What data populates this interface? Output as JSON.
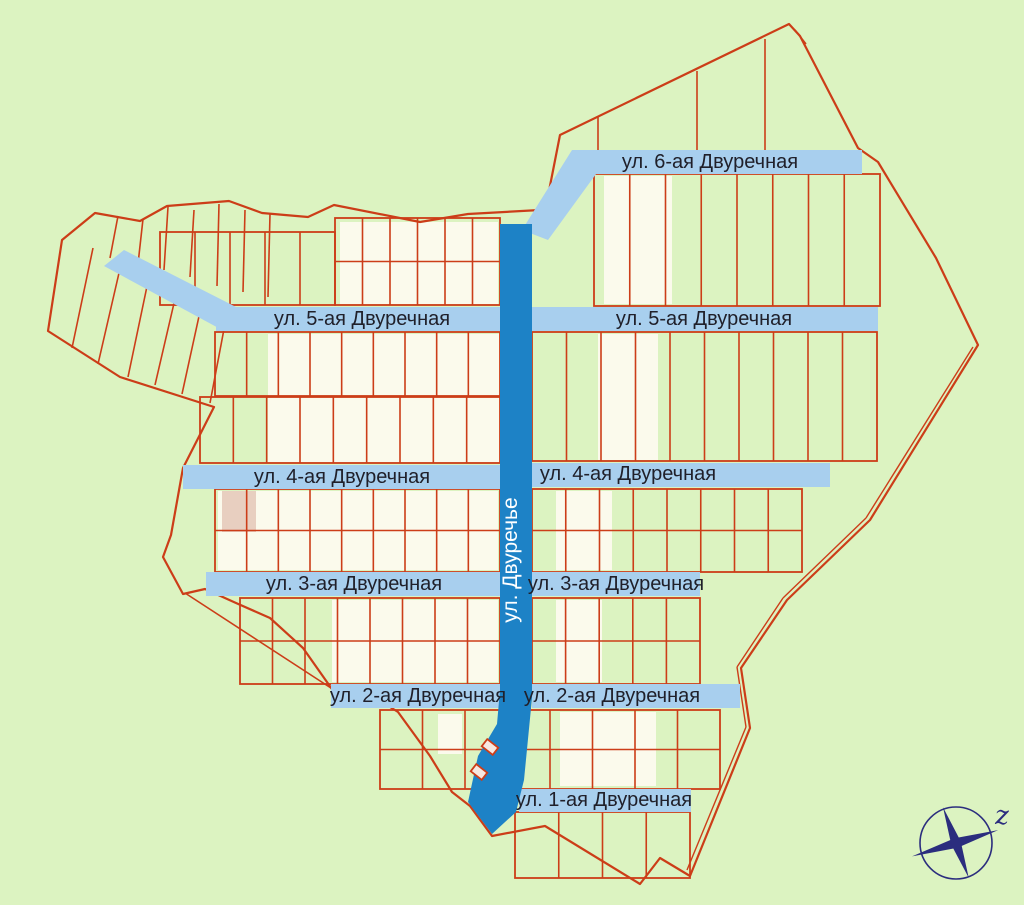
{
  "canvas": {
    "w": 1024,
    "h": 905
  },
  "colors": {
    "bg": "#dcf3c1",
    "parcel_white": "#fbfaec",
    "parcel_tan": "#e8cfc0",
    "line_red": "#cc3d18",
    "street_blue": "#a8cfee",
    "street_dark_blue": "#1d82c6",
    "label_text": "#20202a",
    "central_label_text": "#ffffff",
    "compass_navy": "#2b2d7e",
    "building_fill": "#f7e8e0"
  },
  "map": {
    "boundary": "95,213 140,221 167,206 229,201 262,213 308,217 334,205 420,222 468,214 540,210 548,196 560,135 789,24 800,36 858,148 878,162 936,258 978,345 870,520 787,600 741,668 750,728 690,876 660,858 640,884 545,826 492,836 470,806 452,792 430,756 398,712 357,686 334,692 303,648 270,618 236,603 205,589 183,594 163,557 171,535 183,468 214,407 120,377 48,331 62,240",
    "road_lines": [
      [
        973,
        347,
        866,
        518
      ],
      [
        866,
        518,
        783,
        598
      ],
      [
        783,
        598,
        737,
        667
      ],
      [
        737,
        667,
        746,
        727
      ],
      [
        746,
        727,
        687,
        870
      ]
    ],
    "extra_lines": [
      [
        93,
        248,
        72,
        348
      ],
      [
        122,
        260,
        98,
        364
      ],
      [
        150,
        272,
        128,
        377
      ],
      [
        178,
        286,
        155,
        385
      ],
      [
        203,
        298,
        182,
        394
      ],
      [
        228,
        308,
        210,
        403
      ],
      [
        118,
        216,
        110,
        258
      ],
      [
        143,
        219,
        138,
        264
      ],
      [
        168,
        207,
        164,
        270
      ],
      [
        194,
        210,
        190,
        277
      ],
      [
        219,
        204,
        217,
        286
      ],
      [
        245,
        210,
        243,
        292
      ],
      [
        270,
        214,
        268,
        297
      ],
      [
        598,
        117,
        598,
        150
      ],
      [
        697,
        71,
        697,
        151
      ],
      [
        765,
        39,
        765,
        152
      ],
      [
        795,
        30,
        806,
        44
      ],
      [
        185,
        593,
        334,
        690
      ]
    ],
    "patches": [
      {
        "x": 340,
        "y": 222,
        "w": 158,
        "h": 82,
        "fill": "white"
      },
      {
        "x": 268,
        "y": 334,
        "w": 232,
        "h": 128,
        "fill": "white"
      },
      {
        "x": 598,
        "y": 334,
        "w": 60,
        "h": 126,
        "fill": "white"
      },
      {
        "x": 218,
        "y": 491,
        "w": 280,
        "h": 79,
        "fill": "white"
      },
      {
        "x": 556,
        "y": 491,
        "w": 56,
        "h": 79,
        "fill": "white"
      },
      {
        "x": 332,
        "y": 600,
        "w": 166,
        "h": 82,
        "fill": "white"
      },
      {
        "x": 556,
        "y": 600,
        "w": 46,
        "h": 82,
        "fill": "white"
      },
      {
        "x": 604,
        "y": 176,
        "w": 68,
        "h": 128,
        "fill": "white"
      },
      {
        "x": 560,
        "y": 712,
        "w": 96,
        "h": 74,
        "fill": "white"
      },
      {
        "x": 420,
        "y": 242,
        "w": 78,
        "h": 62,
        "fill": "white"
      },
      {
        "x": 438,
        "y": 714,
        "w": 24,
        "h": 40,
        "fill": "white"
      },
      {
        "x": 222,
        "y": 491,
        "w": 34,
        "h": 41,
        "fill": "tan"
      }
    ],
    "blocks": [
      {
        "x": 335,
        "y": 218,
        "w": 165,
        "h": 87,
        "cols": 6,
        "rows": 2
      },
      {
        "x": 160,
        "y": 232,
        "w": 175,
        "h": 73,
        "cols": 5,
        "rows": 1
      },
      {
        "x": 215,
        "y": 332,
        "w": 285,
        "h": 64,
        "cols": 9,
        "rows": 1
      },
      {
        "x": 200,
        "y": 397,
        "w": 300,
        "h": 66,
        "cols": 9,
        "rows": 1
      },
      {
        "x": 532,
        "y": 332,
        "w": 345,
        "h": 129,
        "cols": 10,
        "rows": 1
      },
      {
        "x": 215,
        "y": 489,
        "w": 285,
        "h": 83,
        "cols": 9,
        "rows": 2
      },
      {
        "x": 532,
        "y": 489,
        "w": 270,
        "h": 83,
        "cols": 8,
        "rows": 2
      },
      {
        "x": 240,
        "y": 598,
        "w": 260,
        "h": 86,
        "cols": 8,
        "rows": 2
      },
      {
        "x": 532,
        "y": 598,
        "w": 168,
        "h": 86,
        "cols": 5,
        "rows": 2
      },
      {
        "x": 380,
        "y": 710,
        "w": 340,
        "h": 79,
        "cols": 8,
        "rows": 2
      },
      {
        "x": 515,
        "y": 812,
        "w": 175,
        "h": 66,
        "cols": 4,
        "rows": 1
      },
      {
        "x": 594,
        "y": 174,
        "w": 286,
        "h": 132,
        "cols": 8,
        "rows": 1
      }
    ],
    "streets": [
      {
        "shape": "rect",
        "x": 572,
        "y": 150,
        "w": 290,
        "h": 24
      },
      {
        "shape": "poly",
        "points": "572,150 596,174 548,240 522,230"
      },
      {
        "shape": "poly",
        "points": "104,266 124,250 238,308 224,331"
      },
      {
        "shape": "rect",
        "x": 216,
        "y": 307,
        "w": 284,
        "h": 24
      },
      {
        "shape": "rect",
        "x": 532,
        "y": 307,
        "w": 346,
        "h": 24
      },
      {
        "shape": "rect",
        "x": 183,
        "y": 465,
        "w": 317,
        "h": 24
      },
      {
        "shape": "rect",
        "x": 532,
        "y": 463,
        "w": 298,
        "h": 24
      },
      {
        "shape": "rect",
        "x": 206,
        "y": 572,
        "w": 294,
        "h": 24
      },
      {
        "shape": "rect",
        "x": 532,
        "y": 572,
        "w": 168,
        "h": 24
      },
      {
        "shape": "rect",
        "x": 331,
        "y": 684,
        "w": 169,
        "h": 24
      },
      {
        "shape": "rect",
        "x": 532,
        "y": 684,
        "w": 208,
        "h": 24
      },
      {
        "shape": "rect",
        "x": 519,
        "y": 789,
        "w": 172,
        "h": 23
      }
    ],
    "street_labels": [
      {
        "text": "ул. 6-ая Двуречная",
        "x": 710,
        "y": 168
      },
      {
        "text": "ул. 5-ая Двуречная",
        "x": 362,
        "y": 325
      },
      {
        "text": "ул. 5-ая Двуречная",
        "x": 704,
        "y": 325
      },
      {
        "text": "ул. 4-ая Двуречная",
        "x": 342,
        "y": 483
      },
      {
        "text": "ул. 4-ая Двуречная",
        "x": 628,
        "y": 480
      },
      {
        "text": "ул. 3-ая Двуречная",
        "x": 354,
        "y": 590
      },
      {
        "text": "ул. 3-ая Двуречная",
        "x": 616,
        "y": 590
      },
      {
        "text": "ул. 2-ая Двуречная",
        "x": 418,
        "y": 702
      },
      {
        "text": "ул. 2-ая Двуречная",
        "x": 612,
        "y": 702
      },
      {
        "text": "ул. 1-ая Двуречная",
        "x": 604,
        "y": 806
      }
    ],
    "central_street": {
      "points": "500,224 532,224 532,698 524,780 516,812 492,834 468,802 478,756 497,724 500,690",
      "label": {
        "text": "ул. Двуречье",
        "x": 517,
        "y": 560,
        "rotate": -90
      }
    },
    "buildings": [
      {
        "cx": 479,
        "cy": 772,
        "w": 14,
        "h": 9,
        "angle": 38
      },
      {
        "cx": 490,
        "cy": 747,
        "w": 14,
        "h": 9,
        "angle": 38
      }
    ],
    "compass": {
      "cx": 956,
      "cy": 843,
      "r": 36,
      "letter": "z",
      "letter_x": 1002,
      "letter_y": 824,
      "diamonds": [
        {
          "angle": -17,
          "r1": 44,
          "r2": 46,
          "w": 5
        },
        {
          "angle": -110,
          "r1": 38,
          "r2": 37,
          "w": 5
        }
      ]
    }
  }
}
